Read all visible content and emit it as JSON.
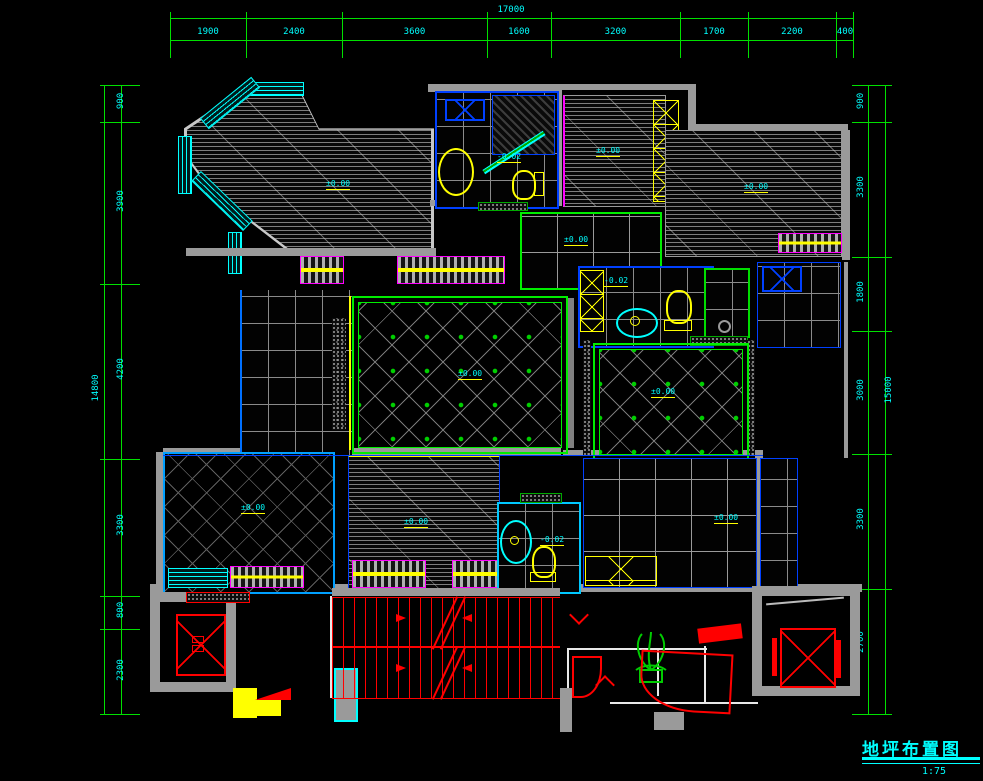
{
  "title": {
    "text": "地坪布置图",
    "scale": "1:75"
  },
  "dims": {
    "top": {
      "total": "17000",
      "segments": [
        "1900",
        "2400",
        "3600",
        "1600",
        "3200",
        "1700",
        "2200",
        "400"
      ]
    },
    "left": {
      "total": "14800",
      "segments": [
        "900",
        "3900",
        "4200",
        "3300",
        "800",
        "2300"
      ]
    },
    "right": {
      "total": "15000",
      "segments": [
        "900",
        "3300",
        "1800",
        "3000",
        "3300",
        "2700"
      ]
    }
  },
  "rooms": [
    {
      "name": "master-bedroom",
      "label": "±0.00"
    },
    {
      "name": "bath-top",
      "label": "-0.02"
    },
    {
      "name": "bedroom-top-mid",
      "label": "±0.00"
    },
    {
      "name": "bedroom-top-right",
      "label": "±0.00"
    },
    {
      "name": "dining-room",
      "label": "±0.00"
    },
    {
      "name": "living-room",
      "label": "±0.00"
    },
    {
      "name": "bath-mid",
      "label": "-0.02"
    },
    {
      "name": "family-room",
      "label": "±0.00"
    },
    {
      "name": "bedroom-bottom-left",
      "label": "±0.00"
    },
    {
      "name": "bedroom-bottom-mid",
      "label": "±0.00"
    },
    {
      "name": "bath-bottom",
      "label": "-0.02"
    },
    {
      "name": "bedroom-bottom-right",
      "label": "±0.00"
    }
  ],
  "colors": {
    "dimension_line": "#00e000",
    "dimension_text": "#00ffff",
    "wall": "#9a9a9a",
    "stairs": "#ff0000",
    "fixture": "#ffff00",
    "cabinet": "#ff00ff",
    "tile_accent": "#00cf00",
    "outline": "#0040ff"
  }
}
